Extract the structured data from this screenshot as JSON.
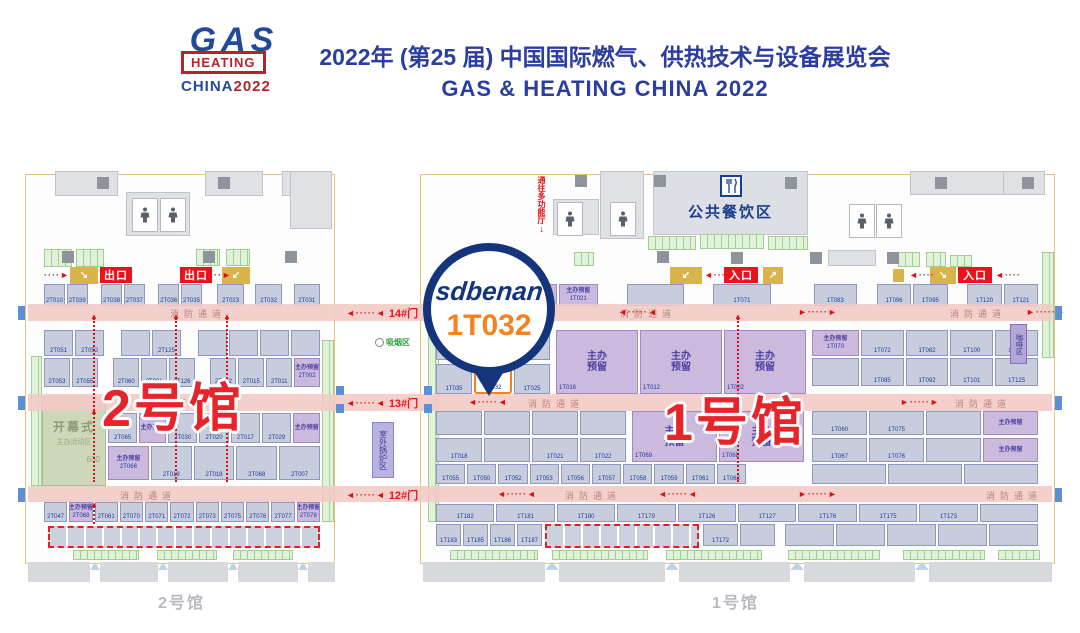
{
  "header": {
    "logo": {
      "gas": "GAS",
      "heating": "HEATING",
      "china": "CHINA",
      "year": "2022"
    },
    "title_cn": "2022年 (第25 届) 中国国际燃气、供热技术与设备展览会",
    "title_en": "GAS & HEATING CHINA 2022"
  },
  "badge": {
    "brand": "sdbenan",
    "booth": "1T032"
  },
  "labels": {
    "fire_lane": "消防通道",
    "reserved": "主办预留",
    "reserved1": "主办",
    "reserved2": "预留",
    "exit": "出口",
    "entrance": "入口",
    "dining": "公共餐饮区",
    "to_hall": "通往多功能厅",
    "smoking": "吸烟区",
    "outdoor": "室外锅炉区",
    "coffee": "咖啡区",
    "opening1": "开幕式",
    "opening2": "主办活动区",
    "opening_no": "630",
    "hall1_big": "1号馆",
    "hall2_big": "2号馆",
    "hall1_footer": "1号馆",
    "hall2_footer": "2号馆"
  },
  "corridor": {
    "gates": [
      "14#门",
      "13#门",
      "12#门"
    ]
  },
  "plan": {
    "halls": [
      [
        25,
        174,
        310,
        390
      ],
      [
        420,
        174,
        635,
        390
      ]
    ],
    "rooms": [
      [
        55,
        171,
        63,
        25
      ],
      [
        205,
        171,
        58,
        25
      ],
      [
        282,
        171,
        48,
        25
      ],
      [
        290,
        171,
        42,
        58
      ],
      [
        126,
        192,
        64,
        44
      ],
      [
        553,
        199,
        46,
        36
      ],
      [
        600,
        171,
        44,
        68
      ],
      [
        910,
        171,
        96,
        24
      ],
      [
        1003,
        171,
        42,
        24
      ],
      [
        828,
        250,
        48,
        16
      ]
    ],
    "pillars": [
      [
        97,
        177
      ],
      [
        218,
        177
      ],
      [
        62,
        251
      ],
      [
        203,
        251
      ],
      [
        285,
        251
      ],
      [
        575,
        175
      ],
      [
        654,
        175
      ],
      [
        785,
        177
      ],
      [
        935,
        177
      ],
      [
        1022,
        177
      ],
      [
        657,
        251
      ],
      [
        731,
        252
      ],
      [
        810,
        252
      ],
      [
        887,
        252
      ],
      [
        487,
        251
      ]
    ],
    "restrooms": [
      [
        132,
        198
      ],
      [
        160,
        198
      ],
      [
        557,
        202
      ],
      [
        610,
        202
      ],
      [
        849,
        204
      ],
      [
        876,
        204
      ]
    ],
    "clusters": [
      [
        44,
        249,
        28,
        18
      ],
      [
        76,
        249,
        28,
        18
      ],
      [
        196,
        249,
        24,
        17
      ],
      [
        226,
        249,
        24,
        17
      ],
      [
        648,
        236,
        48,
        14
      ],
      [
        700,
        234,
        64,
        15
      ],
      [
        768,
        236,
        40,
        14
      ],
      [
        574,
        252,
        20,
        14
      ],
      [
        898,
        252,
        22,
        15
      ],
      [
        926,
        252,
        20,
        15
      ],
      [
        950,
        255,
        22,
        12
      ]
    ],
    "gstrips": [
      [
        31,
        356,
        11,
        130
      ],
      [
        322,
        340,
        12,
        182
      ],
      [
        428,
        296,
        11,
        226
      ],
      [
        1042,
        252,
        12,
        106
      ],
      [
        73,
        550,
        66,
        10
      ],
      [
        157,
        550,
        60,
        10
      ],
      [
        233,
        550,
        60,
        10
      ],
      [
        450,
        550,
        88,
        10
      ],
      [
        552,
        550,
        96,
        10
      ],
      [
        666,
        550,
        96,
        10
      ],
      [
        788,
        550,
        92,
        10
      ],
      [
        903,
        550,
        82,
        10
      ],
      [
        998,
        550,
        42,
        10
      ]
    ],
    "lanes": [
      {
        "y": 304,
        "h": 17,
        "labels": [
          170,
          620,
          950
        ],
        "arrows": [
          [
            618,
            "l"
          ],
          [
            798,
            "r"
          ],
          [
            1026,
            "r"
          ]
        ]
      },
      {
        "y": 394,
        "h": 17,
        "labels": [
          150,
          528,
          955
        ],
        "arrows": [
          [
            468,
            "l"
          ],
          [
            900,
            "r"
          ]
        ]
      },
      {
        "y": 486,
        "h": 16,
        "labels": [
          120,
          565,
          986
        ],
        "arrows": [
          [
            497,
            "l"
          ],
          [
            658,
            "l"
          ],
          [
            798,
            "r"
          ]
        ]
      }
    ],
    "gatex": 346,
    "rows": [
      [
        44,
        284,
        276,
        22,
        [
          [
            "2T010"
          ],
          [
            "2T039"
          ],
          [
            "",
            0.4,
            "g"
          ],
          [
            "2T038"
          ],
          [
            "2T037"
          ],
          [
            "",
            0.4,
            "g"
          ],
          [
            "2T036"
          ],
          [
            "2T035"
          ],
          [
            "",
            0.5,
            "g"
          ],
          [
            "2T023",
            1.3
          ],
          [
            "",
            0.3,
            "g"
          ],
          [
            "2T032",
            1.3
          ],
          [
            "",
            0.3,
            "g"
          ],
          [
            "2T031",
            1.3
          ]
        ]
      ],
      [
        44,
        330,
        276,
        26,
        [
          [
            "2T051"
          ],
          [
            "2T052"
          ],
          [
            "",
            0.4,
            "g"
          ],
          [
            "",
            1
          ],
          [
            "2T125"
          ],
          [
            "",
            0.4,
            "g"
          ],
          [
            "",
            1
          ],
          [
            "",
            1
          ],
          [
            "",
            1
          ],
          [
            "",
            1
          ]
        ]
      ],
      [
        44,
        358,
        276,
        29,
        [
          [
            "2T053"
          ],
          [
            "2T055"
          ],
          [
            "",
            0.4,
            "g"
          ],
          [
            "2T060"
          ],
          [
            "2T001"
          ],
          [
            "2T126"
          ],
          [
            "",
            0.4,
            "g"
          ],
          [
            "2T022"
          ],
          [
            "2T015"
          ],
          [
            "2T011"
          ],
          [
            "2T002",
            1,
            "r"
          ]
        ]
      ],
      [
        108,
        413,
        212,
        30,
        [
          [
            "2T065"
          ],
          [
            "",
            0.9,
            "r"
          ],
          [
            "2T030"
          ],
          [
            "2T020"
          ],
          [
            "2T017"
          ],
          [
            "2T029"
          ],
          [
            "",
            0.9,
            "r"
          ]
        ]
      ],
      [
        108,
        446,
        212,
        34,
        [
          [
            "2T066",
            1,
            "r"
          ],
          [
            "2T019"
          ],
          [
            "2T018"
          ],
          [
            "2T068"
          ],
          [
            "2T007"
          ]
        ]
      ],
      [
        44,
        502,
        276,
        20,
        [
          [
            "2T047"
          ],
          [
            "2T068",
            1,
            "r"
          ],
          [
            "2T061"
          ],
          [
            "2T070"
          ],
          [
            "2T071"
          ],
          [
            "2T072"
          ],
          [
            "2T073"
          ],
          [
            "2T075"
          ],
          [
            "2T076"
          ],
          [
            "2T077"
          ],
          [
            "2T078",
            1,
            "r"
          ]
        ]
      ],
      [
        436,
        284,
        602,
        22,
        [
          [
            "1T017",
            0.8,
            "r"
          ],
          [
            "1T015",
            0.8,
            "r"
          ],
          [
            "1T013",
            0.8,
            "r"
          ],
          [
            "1T021",
            0.8,
            "r"
          ],
          [
            "",
            0.5,
            "g"
          ],
          [
            "",
            1.2
          ],
          [
            "",
            0.5,
            "g"
          ],
          [
            "1T071",
            1.2
          ],
          [
            "",
            0.8,
            "g"
          ],
          [
            "1T083",
            0.9
          ],
          [
            "",
            0.3,
            "g"
          ],
          [
            "1T096",
            0.7
          ],
          [
            "1T095",
            0.7
          ],
          [
            "",
            0.3,
            "g"
          ],
          [
            "1T120",
            0.7
          ],
          [
            "1T121",
            0.7
          ]
        ]
      ],
      [
        436,
        330,
        114,
        30,
        [
          [
            "",
            1
          ],
          [
            "",
            1
          ]
        ]
      ],
      [
        436,
        364,
        114,
        30,
        [
          [
            "1T035"
          ],
          [
            "1T032",
            1,
            "h"
          ],
          [
            "1T025"
          ]
        ]
      ],
      [
        556,
        330,
        250,
        64,
        [
          [
            "1T016",
            1,
            "R"
          ],
          [
            "1T012",
            1,
            "R"
          ],
          [
            "1T002",
            1,
            "R"
          ]
        ]
      ],
      [
        812,
        330,
        226,
        26,
        [
          [
            "1T070",
            1.1,
            "r"
          ],
          [
            "1T072"
          ],
          [
            "1T082"
          ],
          [
            "1T100"
          ],
          [
            "1T110"
          ]
        ]
      ],
      [
        812,
        358,
        226,
        28,
        [
          [
            "",
            1.1
          ],
          [
            "1T085"
          ],
          [
            "1T092"
          ],
          [
            "1T101"
          ],
          [
            "1T125"
          ]
        ]
      ],
      [
        436,
        411,
        190,
        24,
        [
          [
            "",
            1
          ],
          [
            "",
            1
          ],
          [
            "",
            1
          ],
          [
            "",
            1
          ]
        ]
      ],
      [
        436,
        438,
        190,
        24,
        [
          [
            "1T018"
          ],
          [
            "",
            1
          ],
          [
            "1T021"
          ],
          [
            "1T022"
          ]
        ]
      ],
      [
        632,
        411,
        172,
        51,
        [
          [
            "1T069",
            1,
            "R"
          ],
          [
            "1T068",
            1,
            "R"
          ]
        ]
      ],
      [
        812,
        411,
        226,
        24,
        [
          [
            "1T060"
          ],
          [
            "1T075"
          ],
          [
            "",
            1
          ],
          [
            "",
            1,
            "r"
          ]
        ]
      ],
      [
        812,
        438,
        226,
        24,
        [
          [
            "1T067"
          ],
          [
            "1T076"
          ],
          [
            "",
            1
          ],
          [
            "",
            1,
            "r"
          ]
        ]
      ],
      [
        436,
        464,
        310,
        20,
        [
          [
            "1T055"
          ],
          [
            "1T050"
          ],
          [
            "1T052"
          ],
          [
            "1T053"
          ],
          [
            "1T056"
          ],
          [
            "1T057"
          ],
          [
            "1T058"
          ],
          [
            "1T059"
          ],
          [
            "1T061"
          ],
          [
            "1T062"
          ]
        ]
      ],
      [
        812,
        464,
        226,
        20,
        [
          [
            "",
            1
          ],
          [
            "",
            1
          ],
          [
            "",
            1
          ]
        ]
      ],
      [
        436,
        504,
        602,
        18,
        [
          [
            "1T182"
          ],
          [
            "1T181"
          ],
          [
            "1T180"
          ],
          [
            "1T179"
          ],
          [
            "1T126"
          ],
          [
            "1T127"
          ],
          [
            "1T176"
          ],
          [
            "1T175"
          ],
          [
            "1T173"
          ],
          [
            "",
            1
          ]
        ]
      ],
      [
        436,
        524,
        106,
        22,
        [
          [
            "1T183"
          ],
          [
            "1T185"
          ],
          [
            "1T186"
          ],
          [
            "1T187"
          ]
        ]
      ],
      [
        703,
        524,
        72,
        22,
        [
          [
            "1T172"
          ],
          [
            "",
            1
          ]
        ]
      ],
      [
        785,
        524,
        253,
        22,
        [
          [
            "",
            1
          ],
          [
            "",
            1
          ],
          [
            "",
            1
          ],
          [
            "",
            1
          ],
          [
            "",
            1
          ]
        ]
      ]
    ],
    "varrows": [
      [
        93,
        318,
        164
      ],
      [
        175,
        318,
        164
      ],
      [
        226,
        318,
        164
      ],
      [
        737,
        318,
        164
      ],
      [
        93,
        506,
        18
      ]
    ],
    "dashzones": [
      [
        48,
        526,
        272,
        22
      ],
      [
        545,
        524,
        154,
        24
      ]
    ],
    "exits": [
      [
        100,
        267,
        32,
        16
      ],
      [
        180,
        267,
        32,
        16
      ]
    ],
    "entrances": [
      [
        724,
        267,
        34,
        16
      ],
      [
        958,
        267,
        34,
        16
      ]
    ],
    "yellows": [
      [
        70,
        267,
        28,
        17,
        "↘"
      ],
      [
        222,
        267,
        28,
        17,
        "↙"
      ],
      [
        670,
        267,
        32,
        17,
        "↙"
      ],
      [
        763,
        267,
        20,
        17,
        "↗"
      ],
      [
        930,
        267,
        26,
        17,
        "↘"
      ],
      [
        893,
        269,
        11,
        13,
        ""
      ],
      [
        458,
        274,
        13,
        13,
        ""
      ]
    ],
    "harrows": [
      [
        44,
        270,
        "r"
      ],
      [
        206,
        270,
        "r"
      ],
      [
        704,
        270,
        "l"
      ],
      [
        909,
        270,
        "l"
      ],
      [
        995,
        270,
        "l"
      ]
    ],
    "walls": {
      "blocks": [
        [
          28,
          562,
          62,
          20
        ],
        [
          100,
          562,
          58,
          20
        ],
        [
          168,
          562,
          60,
          20
        ],
        [
          238,
          562,
          60,
          20
        ],
        [
          308,
          562,
          27,
          20
        ],
        [
          423,
          562,
          122,
          20
        ],
        [
          559,
          562,
          106,
          20
        ],
        [
          679,
          562,
          111,
          20
        ],
        [
          804,
          562,
          111,
          20
        ],
        [
          929,
          562,
          123,
          20
        ]
      ],
      "notches": [
        [
          90,
          562,
          10
        ],
        [
          158,
          562,
          10
        ],
        [
          228,
          562,
          10
        ],
        [
          298,
          562,
          10
        ],
        [
          545,
          562,
          14
        ],
        [
          665,
          562,
          14
        ],
        [
          790,
          562,
          14
        ],
        [
          915,
          562,
          14
        ]
      ]
    },
    "bluemarks": [
      [
        336,
        386,
        8,
        9
      ],
      [
        336,
        404,
        8,
        9
      ],
      [
        424,
        386,
        8,
        9
      ],
      [
        424,
        404,
        8,
        9
      ],
      [
        18,
        306,
        7,
        14
      ],
      [
        18,
        396,
        7,
        14
      ],
      [
        18,
        488,
        7,
        14
      ],
      [
        1055,
        306,
        7,
        14
      ],
      [
        1055,
        396,
        7,
        14
      ],
      [
        1055,
        488,
        7,
        14
      ]
    ]
  }
}
